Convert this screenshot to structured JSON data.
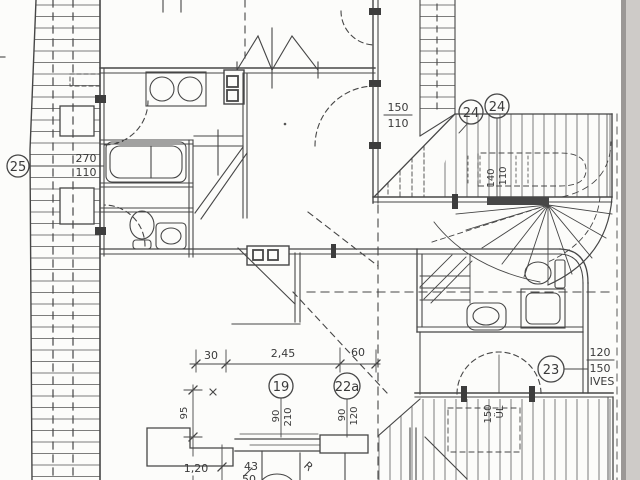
{
  "labels": {
    "marker_25": "25",
    "marker_24a": "24",
    "marker_24b": "24",
    "marker_23": "23",
    "marker_19": "19",
    "marker_22a": "22a",
    "dim_left_window_w": "270",
    "dim_left_window_h": "110",
    "dim_center_window_w": "150",
    "dim_center_window_h": "110",
    "dim_roof_window_w": "140",
    "dim_roof_window_h": "110",
    "dim_right_door_w": "120",
    "dim_right_door_h": "150",
    "dim_right_door_note": "IVES",
    "dim_chain_30": "30",
    "dim_chain_245": "2,45",
    "dim_chain_60": "60",
    "dim_vert_95": "95",
    "dim_vert_120": "1,20",
    "dim_43": "43",
    "dim_50": "50",
    "dim_door19_w": "90",
    "dim_door19_h": "210",
    "dim_door22a_w": "90",
    "dim_door22a_h": "120",
    "dim_balcony_150": "150",
    "dim_balcony_note": "ÜL",
    "radius_mark": "R"
  }
}
